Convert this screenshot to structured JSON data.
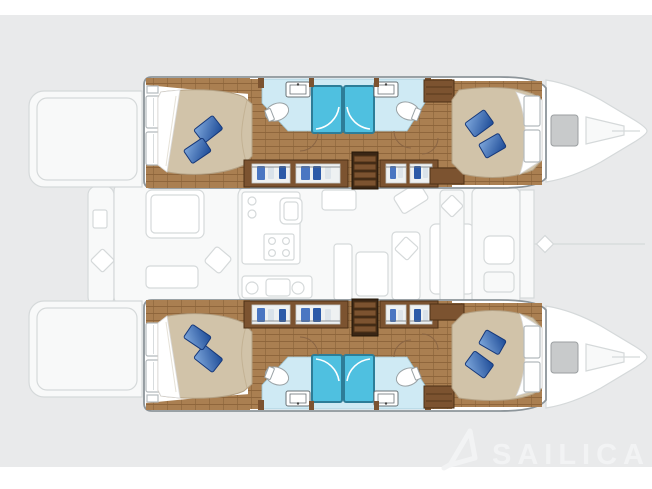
{
  "image": {
    "description": "Catamaran 4-cabin interior layout floor plan, top view, hulls rendered in color over a faded deck plan",
    "background": "#e9eaeb"
  },
  "watermark": {
    "brand": "SAILICA"
  },
  "colors": {
    "panel": "#e9eaeb",
    "hull-outline": "#8d959a",
    "faded-fill": "#f8f9f9",
    "faded-stroke": "#d5d9da",
    "wood-mid": "#aa7f51",
    "wood-line": "#8a6239",
    "wood-cab": "#7c5330",
    "wood-dark": "#4e3116",
    "stair-dark": "#3a2615",
    "bed": "#d1c3a9",
    "bed-edge": "#b3a083",
    "bath": "#cfeaf4",
    "bath-edge": "#9cc3d2",
    "shower": "#4fc0e0",
    "shower-edge": "#2d7d98",
    "pillow-light": "#7fa8dc",
    "pillow-dark": "#1c4a96",
    "pillow-edge": "#16387a",
    "door-arc": "#8a6544",
    "watermark": "#f2f3f4"
  }
}
